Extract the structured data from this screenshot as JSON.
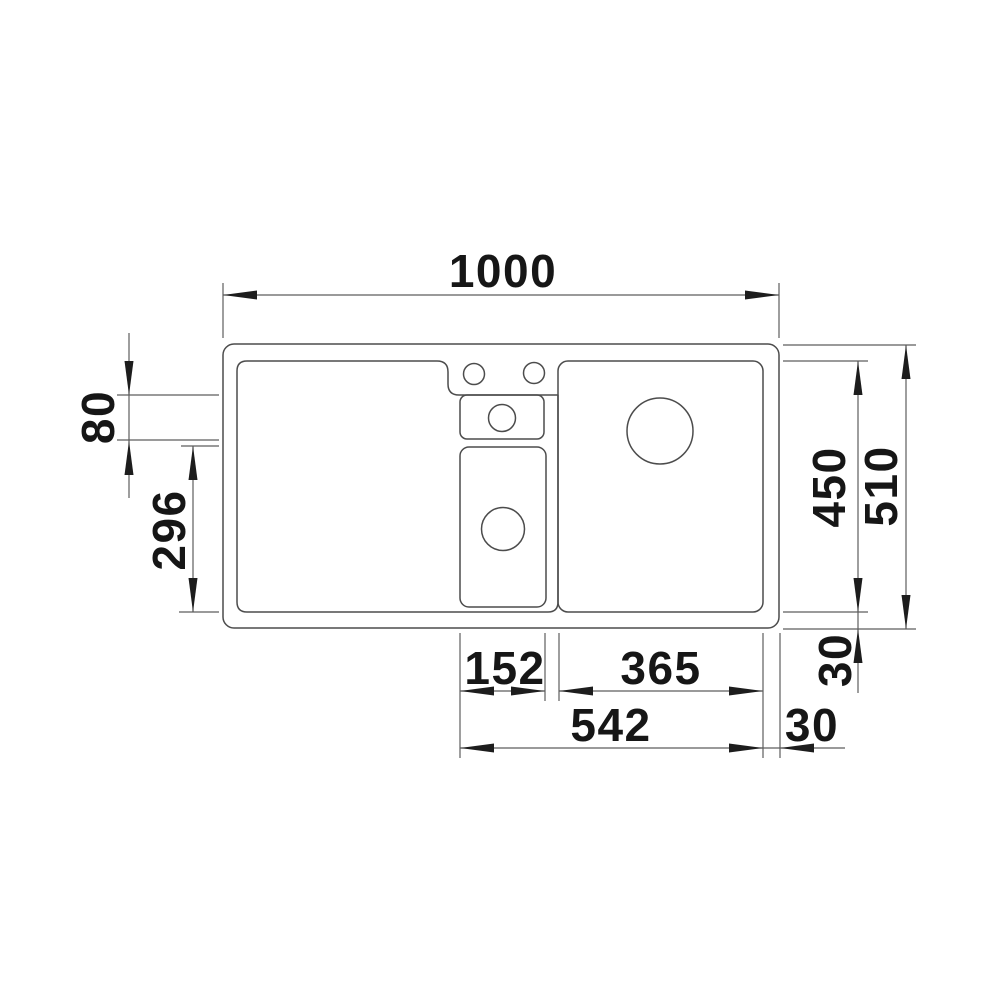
{
  "drawing": {
    "title": "sink-top-view-dimension-drawing",
    "background_color": "#ffffff",
    "line_color": "#4c4c4c",
    "dimension_line_color": "#5d5d5d",
    "text_color": "#161616",
    "dims": {
      "overall_width": "1000",
      "ledge_depth": "80",
      "half_bowl_depth": "296",
      "bowl_depth": "450",
      "overall_depth": "510",
      "bottom_margin": "30",
      "half_bowl_width": "152",
      "main_bowl_width": "365",
      "bowl_span": "542",
      "right_margin": "30"
    }
  }
}
